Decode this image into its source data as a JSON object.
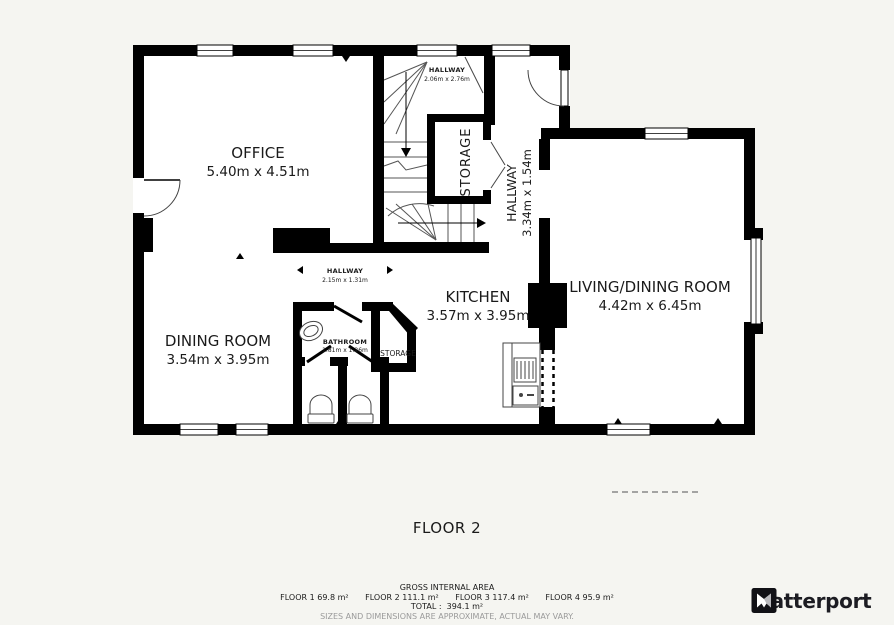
{
  "floorplan": {
    "floor_label": "FLOOR 2",
    "rooms": {
      "office": {
        "name": "OFFICE",
        "dims": "5.40m x 4.51m"
      },
      "hallway_top": {
        "name": "HALLWAY",
        "dims": "2.06m x 2.76m"
      },
      "stairs_storage": {
        "name": "STORAGE"
      },
      "hallway_right": {
        "name": "HALLWAY",
        "dims": "3.34m x 1.54m"
      },
      "living_dining": {
        "name": "LIVING/DINING ROOM",
        "dims": "4.42m x 6.45m"
      },
      "dining": {
        "name": "DINING ROOM",
        "dims": "3.54m x 3.95m"
      },
      "hallway_mid": {
        "name": "HALLWAY",
        "dims": "2.15m x 1.31m"
      },
      "kitchen": {
        "name": "KITCHEN",
        "dims": "3.57m x 3.95m"
      },
      "bathroom": {
        "name": "BATHROOM",
        "dims": "1.81m x 1.26m"
      },
      "storage_small": {
        "name": "STORAGE"
      }
    }
  },
  "footer": {
    "gross_title": "GROSS INTERNAL AREA",
    "floor_areas": [
      {
        "label": "FLOOR 1",
        "area": "69.8 m²"
      },
      {
        "label": "FLOOR 2",
        "area": "111.1 m²"
      },
      {
        "label": "FLOOR 3",
        "area": "117.4 m²"
      },
      {
        "label": "FLOOR 4",
        "area": "95.9 m²"
      }
    ],
    "total_label": "TOTAL :",
    "total_area": "394.1 m²",
    "disclaimer": "SIZES AND DIMENSIONS ARE APPROXIMATE, ACTUAL MAY VARY."
  },
  "brand": {
    "name": "Matterport"
  },
  "colors": {
    "background": "#f5f5f1",
    "wall": "#000000",
    "line": "#444444",
    "text": "#1a1a1a",
    "disclaimer_gray": "#9a9a9a"
  }
}
